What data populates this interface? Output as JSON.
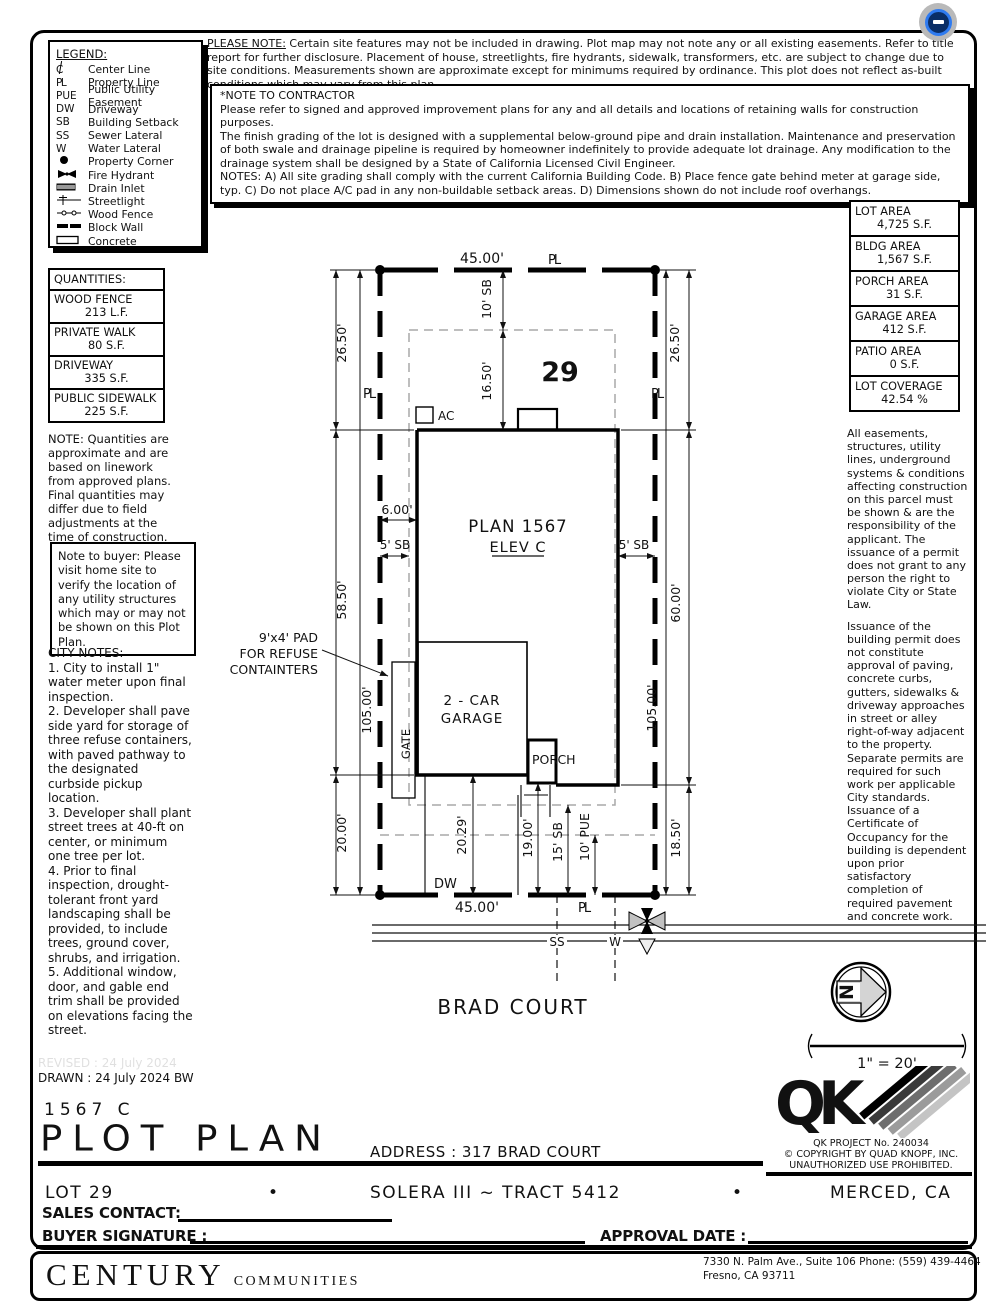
{
  "badge": {
    "bg": "#b9b9b9",
    "ring": "#2f7bf0",
    "fill": "#0a2e66"
  },
  "top_note": {
    "label": "PLEASE NOTE:",
    "text": " Certain site features may not be included in drawing.  Plot map may not note any or all existing easements. Refer to title report for further disclosure.  Placement of house, streetlights, fire hydrants, sidewalk, transformers, etc. are subject to change due to site conditions.  Measurements shown are approximate except for minimums required by ordinance.  This plot does not reflect as-built conditions which may vary from this plan."
  },
  "contractor_note": {
    "title": "*NOTE TO CONTRACTOR",
    "lines": [
      "Please refer to signed and approved improvement plans for any and all details and locations of retaining walls for construction purposes.",
      "The finish grading of the lot is designed with a supplemental below-ground pipe and drain installation.  Maintenance and preservation of both swale and drainage pipeline is required by homeowner indefinitely to provide adequate lot drainage.  Any modification to the drainage system shall be designed by a State of California Licensed Civil Engineer.",
      "NOTES:  A) All site grading shall comply with the current California Building Code.  B) Place fence gate behind meter at garage side, typ.  C) Do not place A/C pad in any non-buildable setback areas.  D) Dimensions shown do not include roof overhangs."
    ]
  },
  "legend": {
    "title": "LEGEND:",
    "items": [
      {
        "symbol": "C",
        "icon": "centerline-symbol",
        "label": "Center Line"
      },
      {
        "symbol": "PL",
        "icon": "property-line-symbol",
        "label": "Property Line"
      },
      {
        "symbol": "PUE",
        "icon": null,
        "label": "Public Utility Easement"
      },
      {
        "symbol": "DW",
        "icon": null,
        "label": "Driveway"
      },
      {
        "symbol": "SB",
        "icon": null,
        "label": "Building Setback"
      },
      {
        "symbol": "SS",
        "icon": null,
        "label": "Sewer Lateral"
      },
      {
        "symbol": "W",
        "icon": null,
        "label": "Water Lateral"
      },
      {
        "symbol": null,
        "icon": "property-corner-icon",
        "label": "Property Corner"
      },
      {
        "symbol": null,
        "icon": "fire-hydrant-icon",
        "label": "Fire Hydrant"
      },
      {
        "symbol": null,
        "icon": "drain-inlet-icon",
        "label": "Drain Inlet"
      },
      {
        "symbol": null,
        "icon": "streetlight-icon",
        "label": "Streetlight"
      },
      {
        "symbol": null,
        "icon": "wood-fence-icon",
        "label": "Wood Fence"
      },
      {
        "symbol": null,
        "icon": "block-wall-icon",
        "label": "Block Wall"
      },
      {
        "symbol": null,
        "icon": "concrete-icon",
        "label": "Concrete"
      }
    ]
  },
  "quantities": {
    "title": "QUANTITIES:",
    "rows": [
      {
        "name": "WOOD FENCE",
        "value": "213 L.F."
      },
      {
        "name": "PRIVATE WALK",
        "value": "80 S.F."
      },
      {
        "name": "DRIVEWAY",
        "value": "335 S.F."
      },
      {
        "name": "PUBLIC SIDEWALK",
        "value": "225 S.F."
      }
    ]
  },
  "quantities_note": "NOTE: Quantities are approximate and are based on linework from approved plans.  Final quantities may differ due to field adjustments at the time of construction.",
  "buyer_note": "Note to buyer: Please visit home site to verify the location of any utility structures which may or may not be shown on this Plot Plan.",
  "city_notes": {
    "title": "CITY NOTES:",
    "items": [
      "1. City to install 1\" water meter upon final inspection.",
      "2. Developer shall pave side yard for storage of three refuse containers, with paved pathway to the designated curbside pickup location.",
      "3. Developer shall plant street trees at 40-ft on center, or minimum one tree per lot.",
      "4. Prior to final inspection, drought-tolerant front yard landscaping shall be provided, to include trees, ground cover, shrubs, and irrigation.",
      "5. Additional window, door, and gable end trim shall be provided on elevations facing the street."
    ]
  },
  "areas": {
    "rows": [
      {
        "name": "LOT AREA",
        "value": "4,725 S.F."
      },
      {
        "name": "BLDG AREA",
        "value": "1,567 S.F."
      },
      {
        "name": "PORCH AREA",
        "value": "31 S.F."
      },
      {
        "name": "GARAGE AREA",
        "value": "412 S.F."
      },
      {
        "name": "PATIO AREA",
        "value": "0 S.F."
      },
      {
        "name": "LOT COVERAGE",
        "value": "42.54 %"
      }
    ]
  },
  "legal_notes": {
    "p1": "All easements, structures, utility lines, underground systems & conditions affecting construction on this parcel must be shown & are the responsibility of the applicant. The issuance of a permit does not grant to any person the right to violate City or State Law.",
    "p2": "Issuance of the building permit does not constitute approval of paving, concrete curbs, gutters, sidewalks & driveway approaches in street or alley right-of-way adjacent to the property. Separate permits are required for such work per applicable City standards. Issuance of a Certificate of Occupancy for the building is dependent upon prior satisfactory completion of required pavement and concrete work."
  },
  "plan": {
    "lot_no": "29",
    "dim45_top": "45.00'",
    "dim45_bot": "45.00'",
    "pl": "PL",
    "dim26_l": "26.50'",
    "dim26_r": "26.50'",
    "dim58": "58.50'",
    "dim60": "60.00'",
    "dim105_l": "105.00'",
    "dim105_r": "105.00'",
    "dim20": "20.00'",
    "dim1850": "18.50'",
    "sb10": "10' SB",
    "dim1650": "16.50'",
    "dim6": "6.00'",
    "sb5_l": "5' SB",
    "sb5_r": "5' SB",
    "plan_name": "PLAN 1567",
    "elev": "ELEV C",
    "ac": "AC",
    "pad1": "9'x4' PAD",
    "pad2": "FOR REFUSE",
    "pad3": "CONTAINTERS",
    "garage1": "2 - CAR",
    "garage2": "GARAGE",
    "gate": "GATE",
    "porch": "PORCH",
    "dim2029": "20.29'",
    "dim19": "19.00'",
    "sb15": "15' SB",
    "pue10": "10' PUE",
    "dw": "DW",
    "ss": "SS",
    "w": "W",
    "street": "BRAD COURT",
    "north": "N",
    "scale": "1\" = 20'"
  },
  "title_block": {
    "revised": "REVISED :  24 July 2024",
    "drawn": "DRAWN :  24 July 2024  BW",
    "plan_code": "1567  C",
    "title": "PLOT PLAN",
    "address": "ADDRESS :  317 BRAD COURT"
  },
  "qk": {
    "logo": "QK",
    "project": "QK PROJECT No. 240034",
    "copyright": "©  COPYRIGHT BY QUAD KNOPF, INC.",
    "warning": "UNAUTHORIZED USE PROHIBITED."
  },
  "footer": {
    "lot": "LOT 29",
    "bullet": "•",
    "tract": "SOLERA III ~ TRACT 5412",
    "city": "MERCED, CA",
    "sales_contact": "SALES CONTACT:",
    "buyer_signature": "BUYER SIGNATURE :",
    "approval_date": "APPROVAL DATE :",
    "brand": "CENTURY",
    "brand2": "COMMUNITIES",
    "addr1": "7330 N. Palm Ave., Suite 106    Phone:  (559) 439-4464",
    "addr2": "Fresno, CA  93711"
  }
}
